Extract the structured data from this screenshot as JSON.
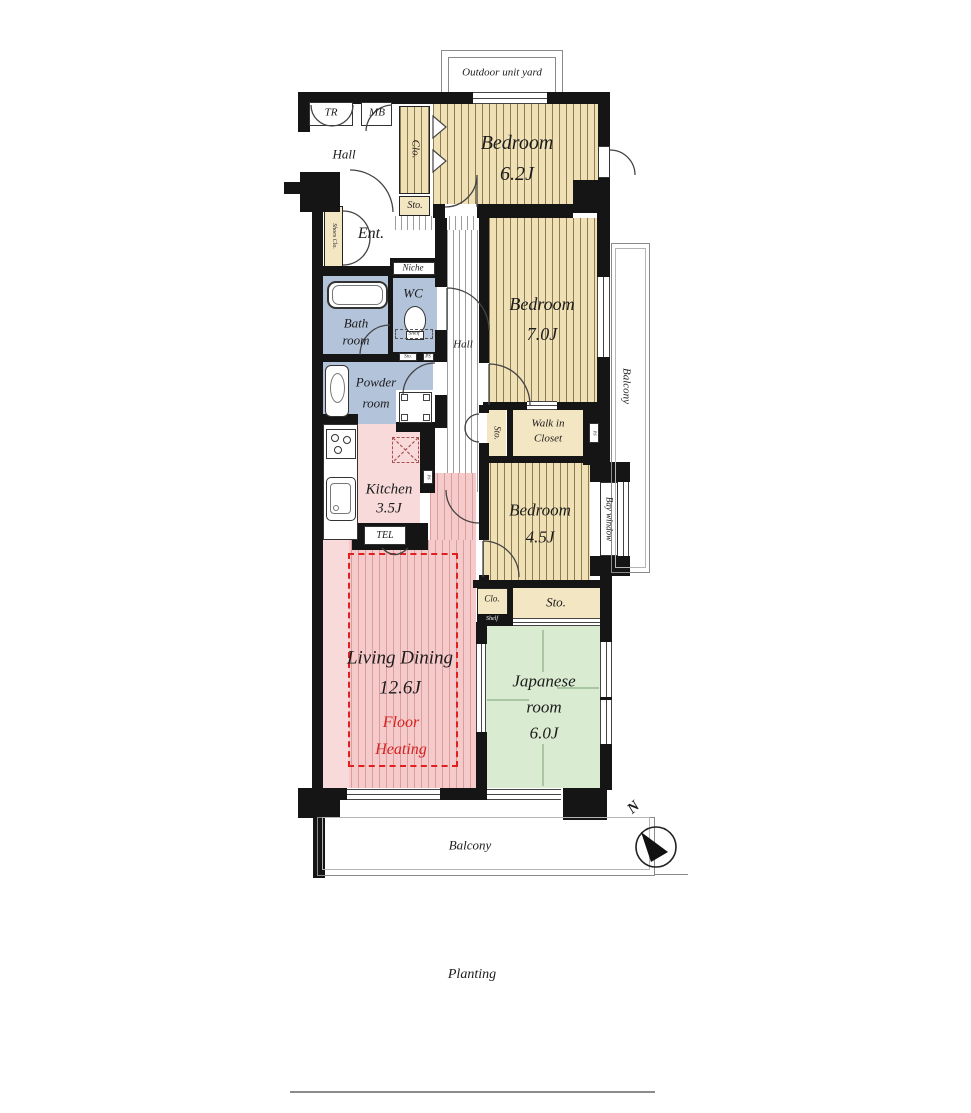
{
  "plan": {
    "title_hint": "apartment floor plan",
    "outdoor_unit_yard": "Outdoor unit yard",
    "tr": "TR",
    "mb": "MB",
    "hall_upper": "Hall",
    "clo_top": "Clo.",
    "sto_top": "Sto.",
    "bedroom1": {
      "name": "Bedroom",
      "size": "6.2J"
    },
    "shoes_clo": "Shoes Clo.",
    "ent": "Ent.",
    "niche": "Niche",
    "wc": "WC",
    "wc_shelf": "Shelf",
    "wc_sto": "Sto.",
    "wc_ps": "PS",
    "bath_line1": "Bath",
    "bath_line2": "room",
    "hall_mid": "Hall",
    "bedroom2": {
      "name": "Bedroom",
      "size": "7.0J"
    },
    "balcony_right": "Balcony",
    "powder_line1": "Powder",
    "powder_line2": "room",
    "sto_mid": "Sto.",
    "walkin_line1": "Walk in",
    "walkin_line2": "Closet",
    "walkin_ps": "PS",
    "kitchen": {
      "name": "Kitchen",
      "size": "3.5J"
    },
    "kitchen_ps": "PS",
    "tel": "TEL",
    "bedroom3": {
      "name": "Bedroom",
      "size": "4.5J"
    },
    "bay_window": "Bay window",
    "clo_small": "Clo.",
    "clo_shelf": "Shelf",
    "sto_jp": "Sto.",
    "living": {
      "name": "Living Dining",
      "size": "12.6J"
    },
    "floor_heating_line1": "Floor",
    "floor_heating_line2": "Heating",
    "japanese_line1": "Japanese",
    "japanese_line2": "room",
    "japanese_size": "6.0J",
    "balcony_bottom": "Balcony",
    "north": "N",
    "planting": "Planting"
  },
  "colors": {
    "wall": "#151515",
    "wood_floor": "#efe0b6",
    "wood_stripe": "#8d7c52",
    "storage": "#f3e6c3",
    "wet_room_blue": "#b3c3da",
    "kitchen_pink": "#f8dada",
    "living_pink": "#f5caca",
    "tatami_green": "#d9ebd1",
    "floor_heating_red": "#e01f1f"
  }
}
